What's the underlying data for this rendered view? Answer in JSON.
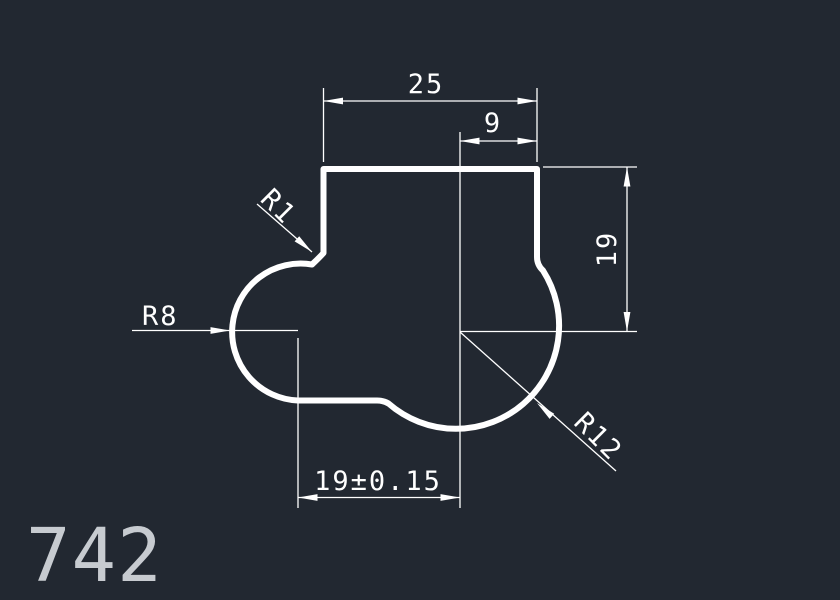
{
  "theme": {
    "background_color": "#222831",
    "line_color": "#ffffff",
    "part_number_color": "#c7cbd0"
  },
  "drawing": {
    "part_number": "742",
    "dimensions": {
      "top_width": "25",
      "top_right_width": "9",
      "right_height": "19",
      "bottom_width": "19±0.15"
    },
    "radii": {
      "notch_fillet": "R1",
      "left_arc": "R8",
      "right_arc": "R12"
    }
  }
}
